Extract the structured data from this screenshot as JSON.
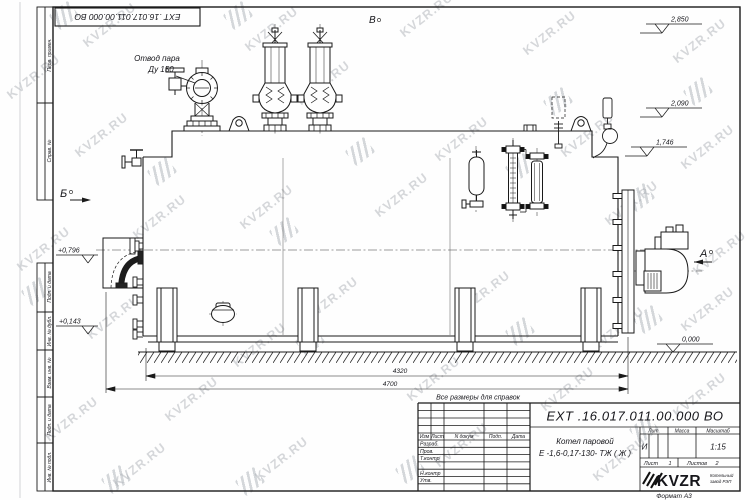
{
  "watermark": {
    "text": "KVZR.RU"
  },
  "sheet": {
    "top_stamp": "ЕХТ .16.017.011.00.000  ВО",
    "format_note": "Формат А3",
    "side_labels": {
      "perv": "Перв. примен.",
      "sprav": "Справ. №",
      "podp1": "Подп. и дата",
      "inv_dubl": "Инв. № дубл.",
      "vzam": "Взам. инв. №",
      "podp2": "Подп. и дата",
      "inv_podl": "Инв. № подл."
    }
  },
  "drawing": {
    "labels": {
      "steam_line1": "Отвод пара",
      "steam_line2": "Ду 150",
      "view_top": "В",
      "view_left": "Б",
      "view_right": "А",
      "ref_note": "Все размеры для справок"
    },
    "elevations": {
      "right": [
        "2,850",
        "2,090",
        "1,746"
      ],
      "left": [
        "+0,796",
        "+0,143"
      ],
      "zero": "0,000"
    },
    "dimensions": {
      "inner": "4320",
      "overall": "4700"
    }
  },
  "title_block": {
    "doc_number": "ЕХТ .16.017.011.00.000  ВО",
    "product_line1": "Котел паровой",
    "product_line2": "Е -1,6-0,17-130- ТЖ ( Ж )",
    "rev_cols": [
      "Изм",
      "Лист",
      "N докум",
      "Подп.",
      "Дата"
    ],
    "sign_rows": [
      "Разраб.",
      "Пров.",
      "Т.контр",
      "Н.контр",
      "Утв."
    ],
    "lit_label": "Лит.",
    "mass_label": "Масса",
    "scale_label": "Масштаб",
    "lit_value": "И",
    "scale_value": "1:15",
    "sheet_label": "Лист",
    "sheet_value": "1",
    "sheets_label": "Листов",
    "sheets_value": "2",
    "brand": "KVZR",
    "brand_sub1": "Котельный",
    "brand_sub2": "завод РЭП"
  }
}
